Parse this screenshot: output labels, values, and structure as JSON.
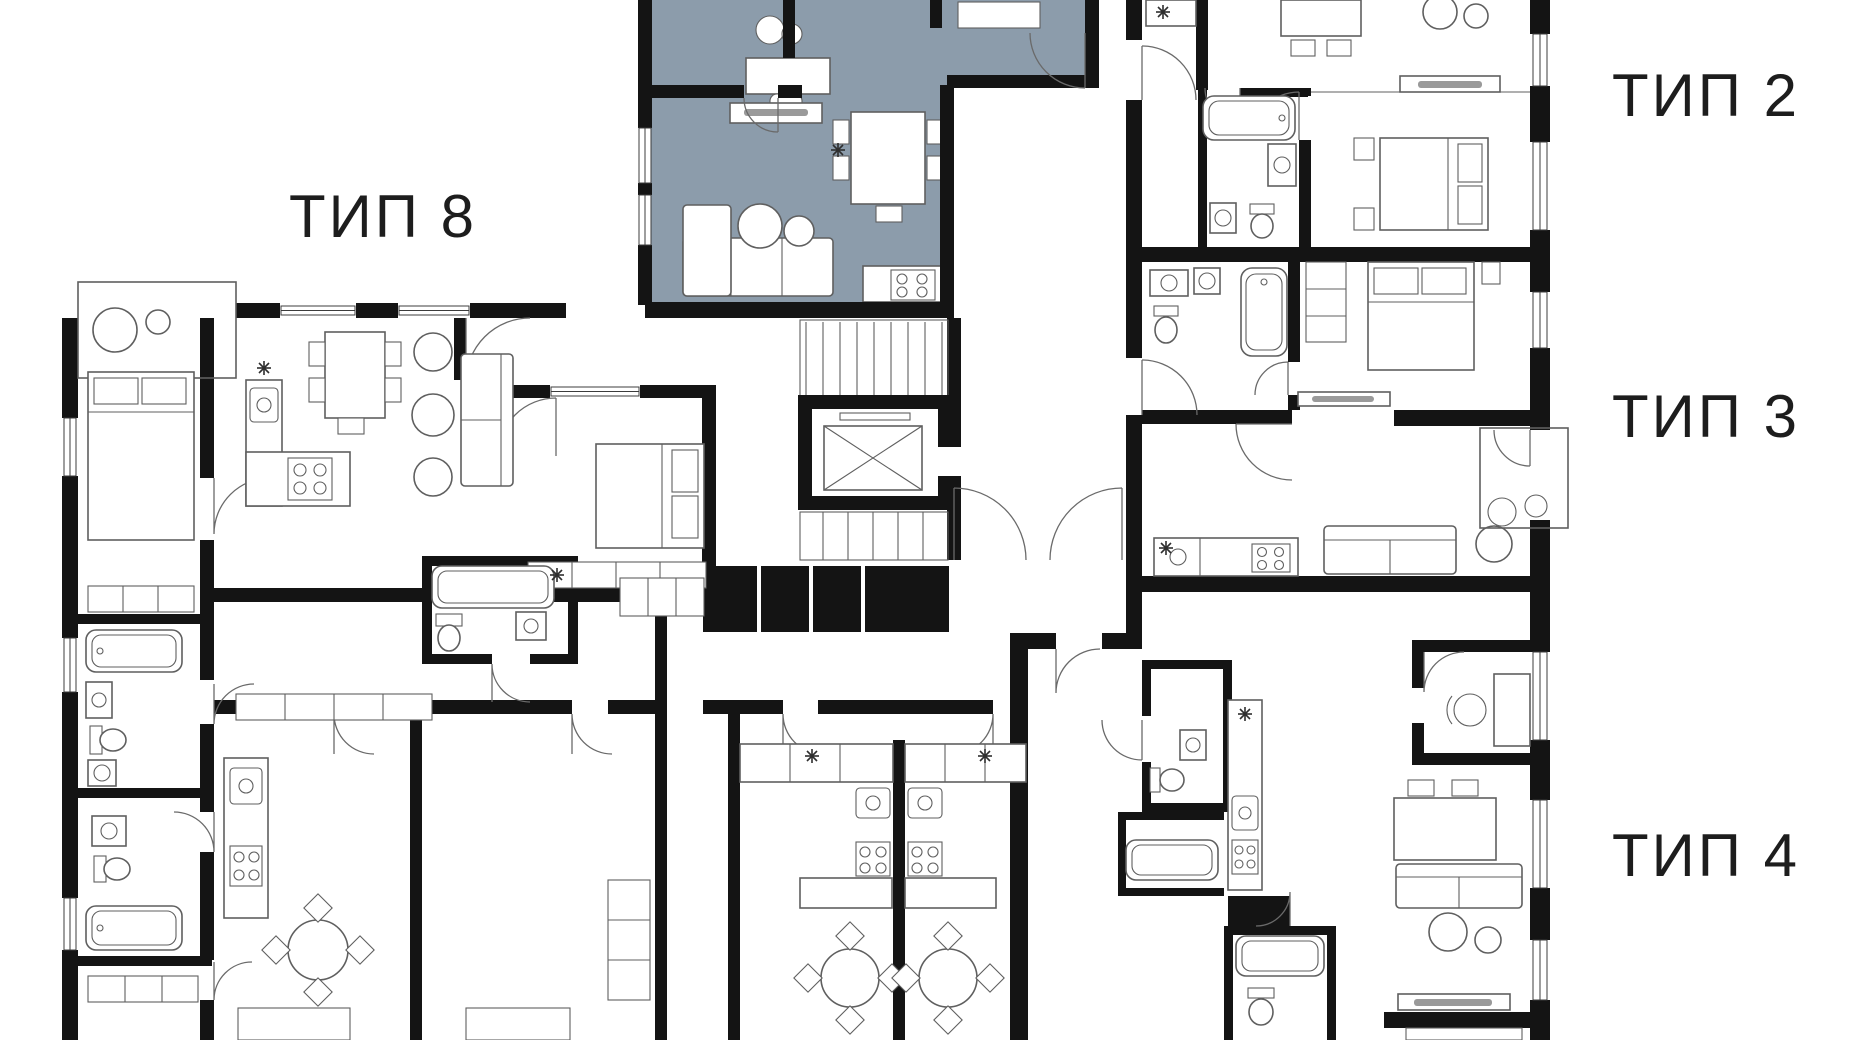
{
  "plan": {
    "type_labels": [
      {
        "id": "tip-8",
        "text": "ТИП 8"
      },
      {
        "id": "tip-2",
        "text": "ТИП 2"
      },
      {
        "id": "tip-3",
        "text": "ТИП 3"
      },
      {
        "id": "tip-4",
        "text": "ТИП 4"
      }
    ],
    "colors": {
      "background": "#ffffff",
      "walls": "#141414",
      "lines": "#5f5f5f",
      "highlight": "#8c9cab",
      "label_text": "#1d1d1d"
    },
    "highlighted_unit": {
      "highlight_color": "#8c9cab"
    }
  }
}
